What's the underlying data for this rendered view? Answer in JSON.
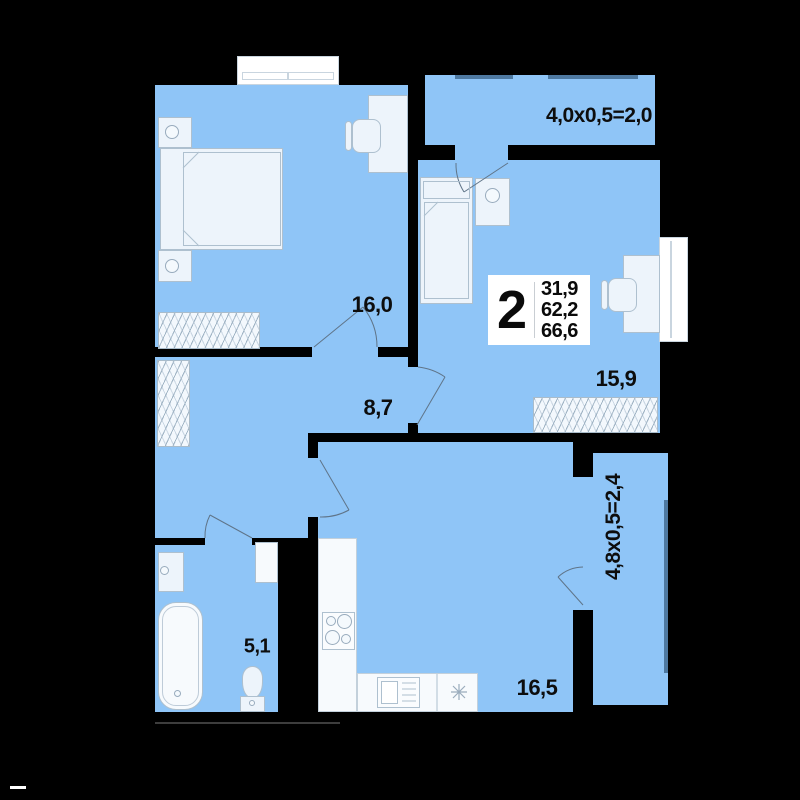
{
  "floor_plan": {
    "unit_info": {
      "rooms_count": "2",
      "area_values": [
        "31,9",
        "62,2",
        "66,6"
      ]
    },
    "rooms": {
      "bedroom": {
        "area": "16,0"
      },
      "bedroom2": {
        "area": "15,9"
      },
      "hallway": {
        "area": "8,7"
      },
      "bathroom": {
        "area": "5,1"
      },
      "kitchen_living": {
        "area": "16,5"
      },
      "balcony_top": {
        "dimensions": "4,0x0,5=2,0"
      },
      "balcony_right": {
        "dimensions": "4,8x0,5=2,4"
      }
    },
    "colors": {
      "room_fill": "#8FC5F7",
      "background": "#000000",
      "furniture_fill": "#EDF4FB",
      "furniture_stroke": "#AEC0CF",
      "railing": "#4E79A1",
      "text": "#0D0D0D"
    }
  }
}
